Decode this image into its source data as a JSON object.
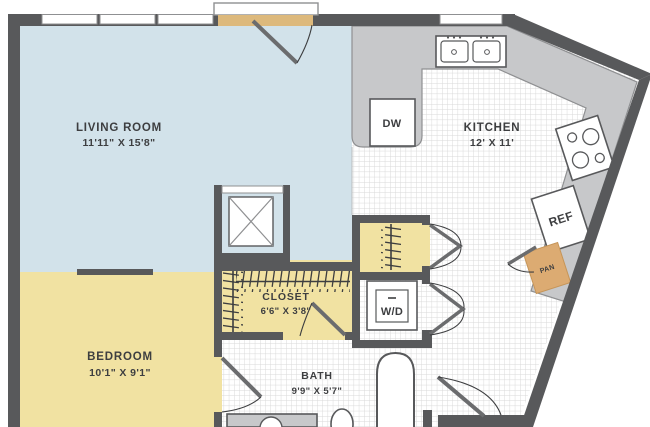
{
  "plan_title": "One bedroom apartment floor plan",
  "rooms": {
    "living_room": {
      "name": "LIVING ROOM",
      "dims": "11'11\" X 15'8\""
    },
    "kitchen": {
      "name": "KITCHEN",
      "dims": "12' X 11'"
    },
    "bedroom": {
      "name": "BEDROOM",
      "dims": "10'1\" X 9'1\""
    },
    "closet": {
      "name": "CLOSET",
      "dims": "6'6\" X 3'8\""
    },
    "bath": {
      "name": "BATH",
      "dims": "9'9\" X 5'7\""
    }
  },
  "appliances": {
    "dishwasher": "DW",
    "washer_dryer": "W/D",
    "refrigerator": "REF",
    "pantry": "PAN"
  },
  "colors": {
    "wall": "#58595b",
    "living_floor": "#d2e2ea",
    "bedroom_floor": "#f1e2a2",
    "counter": "#c7c8ca",
    "entry_threshold": "#ddb97c",
    "pantry_fill": "#dcab72",
    "tile_line": "#d8d8d8",
    "label_text": "#3d3e40"
  }
}
